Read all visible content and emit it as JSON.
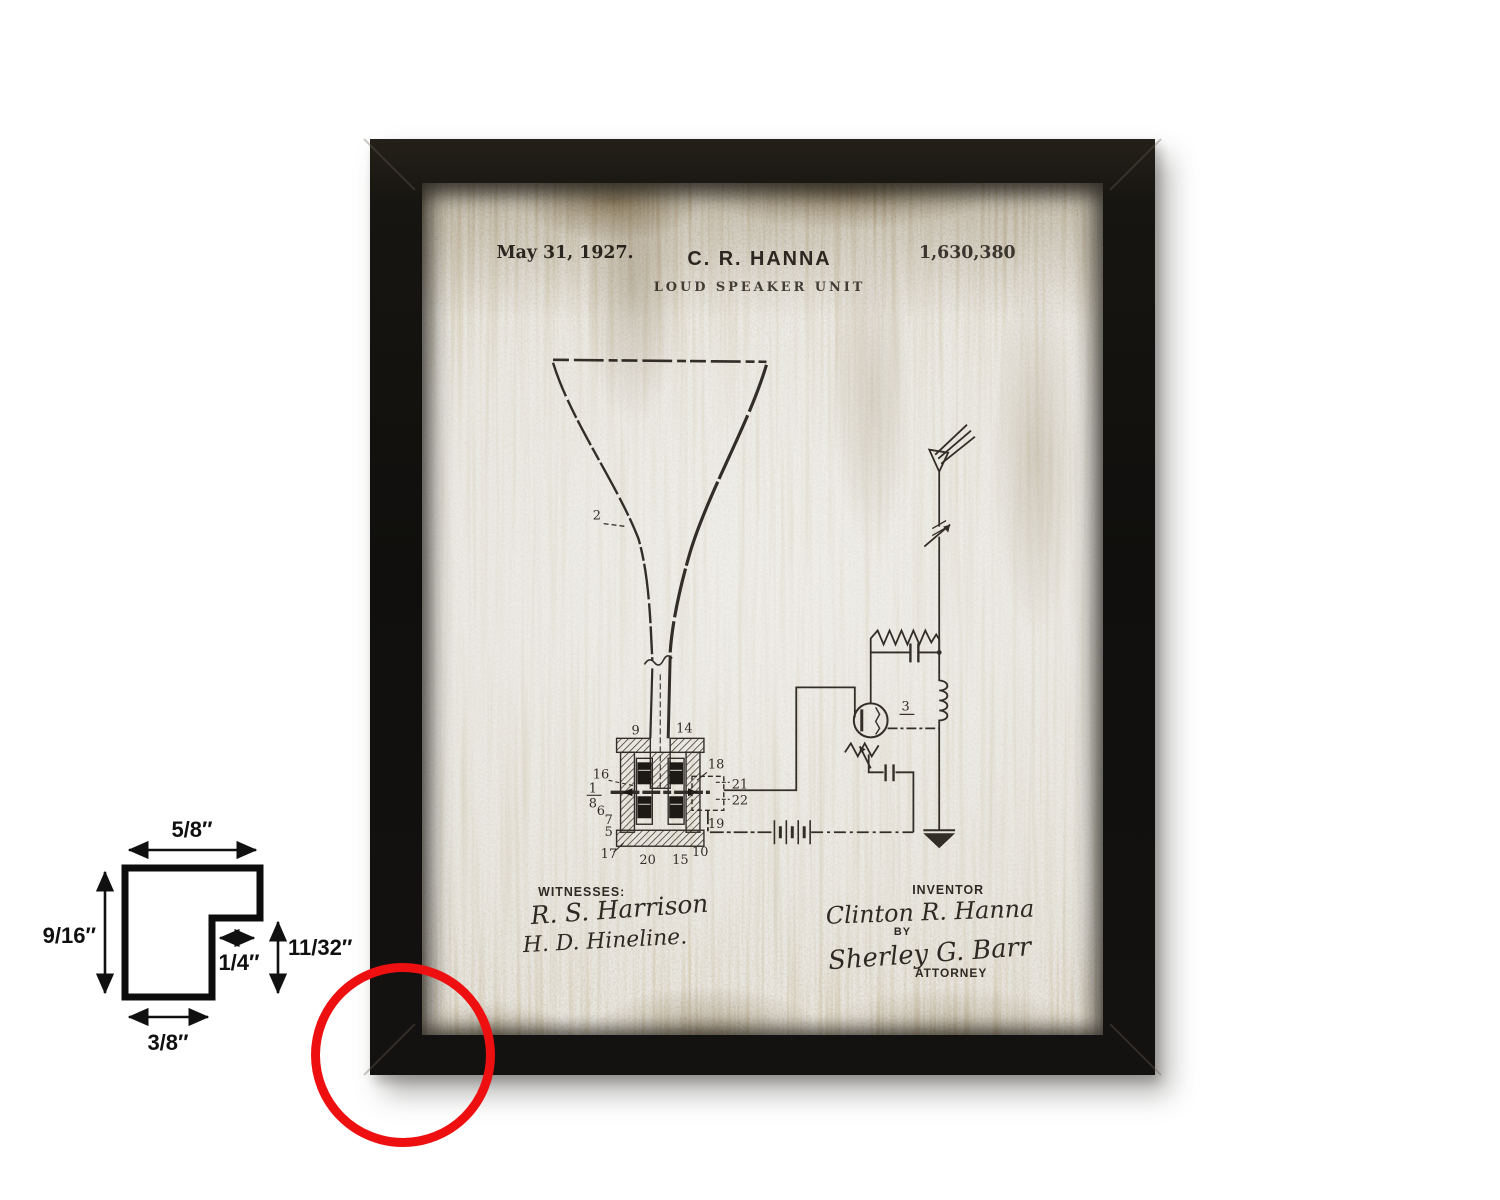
{
  "artwork": {
    "header": {
      "date": "May 31, 1927.",
      "inventor": "C. R. HANNA",
      "patent_number": "1,630,380",
      "title": "LOUD SPEAKER UNIT"
    },
    "figure": {
      "horn_label": "2",
      "circuit_label": "3",
      "part_labels": [
        "9",
        "14",
        "16",
        "18",
        "1",
        "8",
        "6",
        "7",
        "5",
        "17",
        "20",
        "15",
        "10",
        "21",
        "22",
        "19"
      ]
    },
    "footer": {
      "witnesses_label": "WITNESSES:",
      "witness_1": "R. S. Harrison",
      "witness_2": "H. D. Hineline.",
      "inventor_label": "INVENTOR",
      "inventor_signature": "Clinton R. Hanna",
      "by_label": "BY",
      "attorney_signature": "Sherley G. Barr",
      "attorney_label": "ATTORNEY"
    }
  },
  "profile_diagram": {
    "top_width": "5/8″",
    "left_height": "9/16″",
    "step_width": "1/4″",
    "step_height": "11/32″",
    "bottom_width": "3/8″"
  },
  "colors": {
    "background": "#ffffff",
    "frame_black": "#14110e",
    "paper": "#ebe9e3",
    "ink": "#322d26",
    "stain_brown": "#8d774b",
    "highlight_red": "#ee1010"
  }
}
